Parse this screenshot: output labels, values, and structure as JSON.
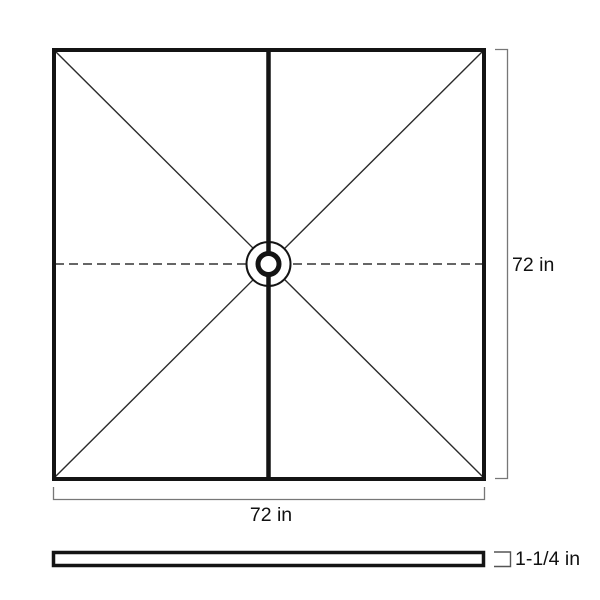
{
  "diagram": {
    "top_view": {
      "width_label": "72 in",
      "height_label": "72 in"
    },
    "side_profile": {
      "thickness_label": "1-1/4 in"
    },
    "colors": {
      "outline": "#141414",
      "thin_line": "#2b2b2b",
      "dashed_line": "#333333",
      "dimension_line": "#777777",
      "bracket_line": "#555555",
      "text": "#111111",
      "background": "#ffffff"
    }
  }
}
